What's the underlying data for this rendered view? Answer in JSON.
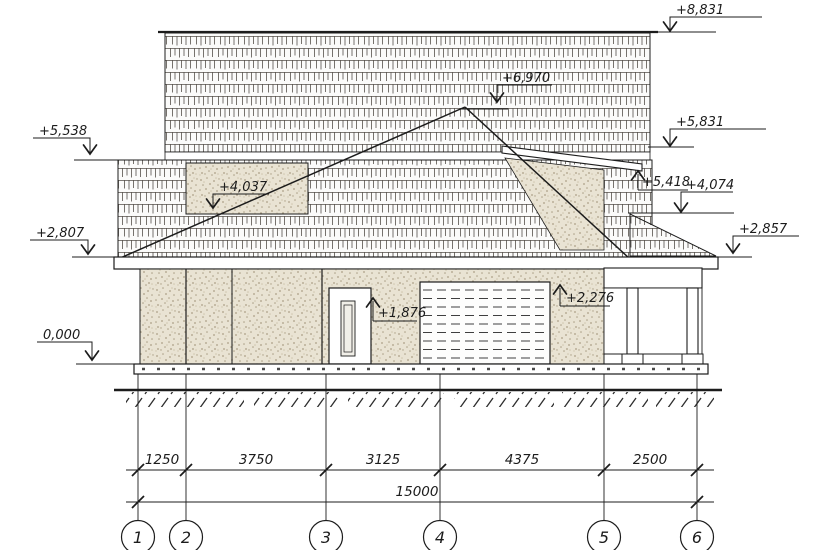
{
  "drawing": {
    "type": "house-facade-elevation",
    "marks": {
      "m8831": "+8,831",
      "m6970": "+6,970",
      "m5831": "+5,831",
      "m5538": "+5,538",
      "m5418": "+5,418",
      "m4074": "+4,074",
      "m4037": "+4,037",
      "m2857": "+2,857",
      "m2807": "+2,807",
      "m2276": "+2,276",
      "m1876": "+1,876",
      "m0": "0,000"
    },
    "dims": {
      "seg1": "1250",
      "seg2": "3750",
      "seg3": "3125",
      "seg4": "4375",
      "seg5": "2500",
      "total": "15000"
    },
    "axes": {
      "a1": "1",
      "a2": "2",
      "a3": "3",
      "a4": "4",
      "a5": "5",
      "a6": "6"
    },
    "colors": {
      "ink": "#1c1c1c",
      "paper": "#ffffff",
      "stucco": "#e9e3d3",
      "stuccoDot": "#ab9f86",
      "shingleLine": "#55504a",
      "slatDash": "#3f3f3f"
    }
  }
}
